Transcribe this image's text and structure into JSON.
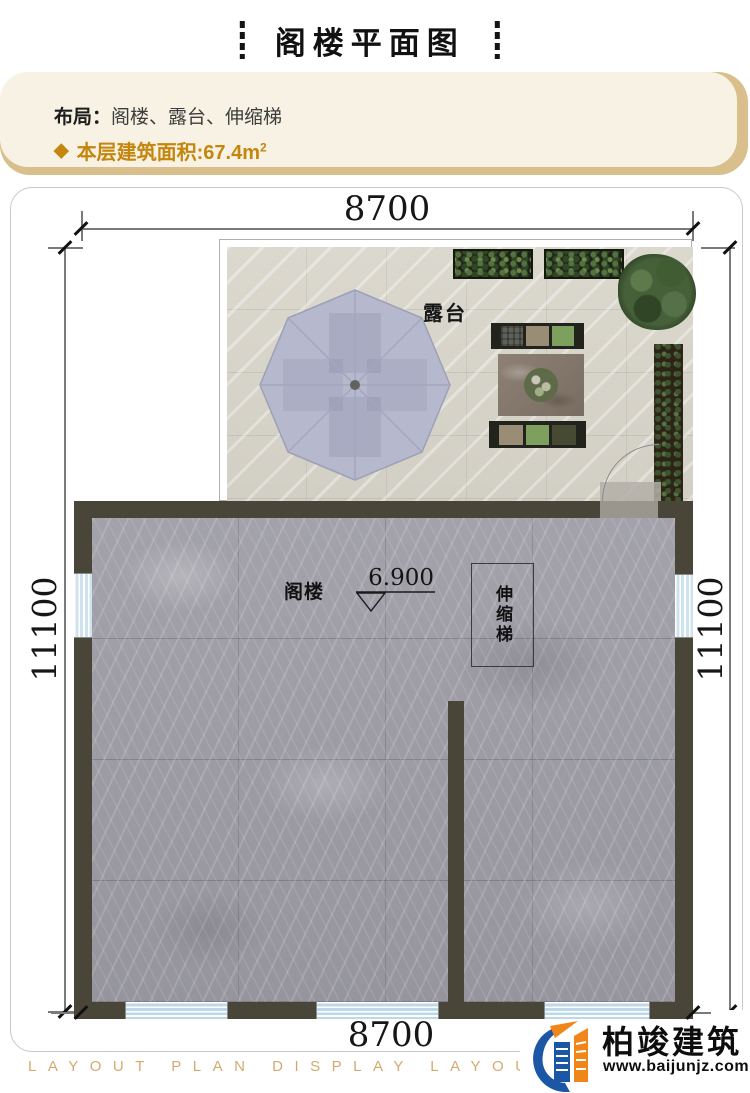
{
  "header": {
    "title": "阁楼平面图"
  },
  "info": {
    "layout_label": "布局：",
    "layout_value": "阁楼、露台、伸缩梯",
    "diamond": "◆",
    "area_label": "本层建筑面积:",
    "area_value": "67.4m",
    "area_sup": "2"
  },
  "plan": {
    "dim_top": "8700",
    "dim_bottom": "8700",
    "dim_left": "11100",
    "dim_right": "11100",
    "terrace_label": "露台",
    "attic_label": "阁楼",
    "ladder_label": "伸缩梯",
    "elevation": "6.900"
  },
  "footer": {
    "watermark": "LAYOUT PLAN DISPLAY LAYOUT PLAN D",
    "logo_text": "柏竣建筑",
    "logo_url": "www.baijunjz.com"
  },
  "colors": {
    "accent_gold": "#c5860e",
    "panel_tan": "#d8bf8c",
    "panel_cream": "#f7f2e3",
    "wall": "#4a4539",
    "marble": "#9b9aa2",
    "terrace_floor": "#d8d5cb",
    "umbrella": "#b6b9ce",
    "window_blue": "#cfe3ef",
    "watermark": "#d3aa6e",
    "logo_blue": "#1c57a5",
    "logo_orange": "#f08519"
  }
}
